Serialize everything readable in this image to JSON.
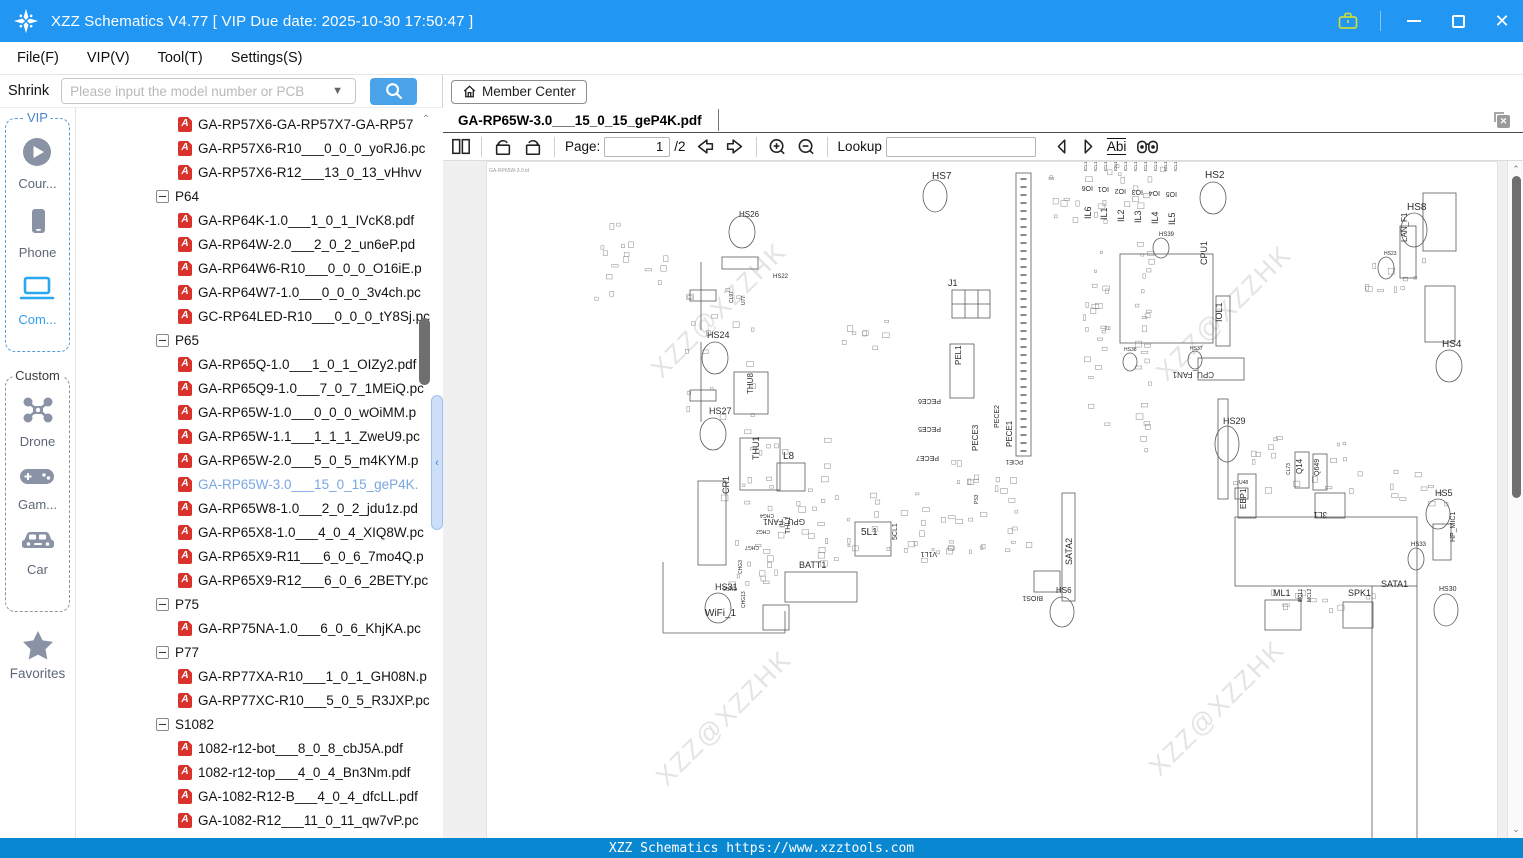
{
  "window": {
    "title": "XZZ Schematics V4.77 [ VIP Due date: 2025-10-30 17:50:47 ]"
  },
  "menu": {
    "items": [
      "File(F)",
      "VIP(V)",
      "Tool(T)",
      "Settings(S)"
    ]
  },
  "search": {
    "shrink_label": "Shrink",
    "placeholder": "Please input the model number or PCB"
  },
  "member_center": {
    "label": "Member Center"
  },
  "sidebar": {
    "groups": [
      {
        "label": "VIP",
        "style": "vip",
        "items": [
          {
            "label": "Cour...",
            "icon": "play-circle-icon",
            "active": false
          },
          {
            "label": "Phone",
            "icon": "phone-icon",
            "active": false
          },
          {
            "label": "Com...",
            "icon": "laptop-icon",
            "active": true
          }
        ]
      },
      {
        "label": "Custom",
        "style": "custom",
        "items": [
          {
            "label": "Drone",
            "icon": "drone-icon",
            "active": false
          },
          {
            "label": "Gam...",
            "icon": "gamepad-icon",
            "active": false
          },
          {
            "label": "Car",
            "icon": "car-icon",
            "active": false
          }
        ]
      }
    ],
    "favorites": {
      "label": "Favorites",
      "icon": "star-icon"
    }
  },
  "tree": {
    "items": [
      {
        "type": "file",
        "label": "GA-RP57X6-GA-RP57X7-GA-RP57"
      },
      {
        "type": "file",
        "label": "GA-RP57X6-R10___0_0_0_yoRJ6.pc"
      },
      {
        "type": "file",
        "label": "GA-RP57X6-R12___13_0_13_vHhvv"
      },
      {
        "type": "group",
        "label": "P64"
      },
      {
        "type": "file",
        "label": "GA-RP64K-1.0___1_0_1_IVcK8.pdf"
      },
      {
        "type": "file",
        "label": "GA-RP64W-2.0___2_0_2_un6eP.pd"
      },
      {
        "type": "file",
        "label": "GA-RP64W6-R10___0_0_0_O16iE.p"
      },
      {
        "type": "file",
        "label": "GA-RP64W7-1.0___0_0_0_3v4ch.pc"
      },
      {
        "type": "file",
        "label": "GC-RP64LED-R10___0_0_0_tY8Sj.pc"
      },
      {
        "type": "group",
        "label": "P65"
      },
      {
        "type": "file",
        "label": "GA-RP65Q-1.0___1_0_1_OIZy2.pdf"
      },
      {
        "type": "file",
        "label": "GA-RP65Q9-1.0___7_0_7_1MEiQ.pc"
      },
      {
        "type": "file",
        "label": "GA-RP65W-1.0___0_0_0_wOiMM.p"
      },
      {
        "type": "file",
        "label": "GA-RP65W-1.1___1_1_1_ZweU9.pc"
      },
      {
        "type": "file",
        "label": "GA-RP65W-2.0___5_0_5_m4KYM.p"
      },
      {
        "type": "file",
        "label": "GA-RP65W-3.0___15_0_15_geP4K.",
        "selected": true
      },
      {
        "type": "file",
        "label": "GA-RP65W8-1.0___2_0_2_jdu1z.pd"
      },
      {
        "type": "file",
        "label": "GA-RP65X8-1.0___4_0_4_XIQ8W.pc"
      },
      {
        "type": "file",
        "label": "GA-RP65X9-R11___6_0_6_7mo4Q.p"
      },
      {
        "type": "file",
        "label": "GA-RP65X9-R12___6_0_6_2BETY.pc"
      },
      {
        "type": "group",
        "label": "P75"
      },
      {
        "type": "file",
        "label": "GA-RP75NA-1.0___6_0_6_KhjKA.pc"
      },
      {
        "type": "group",
        "label": "P77"
      },
      {
        "type": "file",
        "label": "GA-RP77XA-R10___1_0_1_GH08N.p"
      },
      {
        "type": "file",
        "label": "GA-RP77XC-R10___5_0_5_R3JXP.pc"
      },
      {
        "type": "group",
        "label": "S1082"
      },
      {
        "type": "file",
        "label": "1082-r12-bot___8_0_8_cbJ5A.pdf"
      },
      {
        "type": "file",
        "label": "1082-r12-top___4_0_4_Bn3Nm.pdf"
      },
      {
        "type": "file",
        "label": "GA-1082-R12-B___4_0_4_dfcLL.pdf"
      },
      {
        "type": "file",
        "label": "GA-1082-R12___11_0_11_qw7vP.pc"
      }
    ]
  },
  "viewer": {
    "tab": {
      "title": "GA-RP65W-3.0___15_0_15_geP4K.pdf"
    },
    "toolbar": {
      "page_label": "Page:",
      "page_value": "1",
      "page_total": "/2",
      "lookup_label": "Lookup",
      "lookup_value": "",
      "abi_label": "Abi"
    }
  },
  "statusbar": {
    "text": "XZZ Schematics https://www.xzztools.com"
  },
  "schematic": {
    "page_label": "GA-RP65W-3.0.td",
    "stroke": "#5a5a5a",
    "label_color": "#2b2b2b",
    "watermark": {
      "text": "XZZ@XZZHK",
      "color": "#e4e4e4"
    },
    "watermark_positions": [
      [
        238,
        154
      ],
      [
        743,
        157
      ],
      [
        243,
        562
      ],
      [
        736,
        552
      ]
    ],
    "labels": [
      {
        "t": "HS7",
        "x": 445,
        "y": 17,
        "s": 10
      },
      {
        "t": "HS26",
        "x": 252,
        "y": 55,
        "s": 8
      },
      {
        "t": "HS22",
        "x": 286,
        "y": 116,
        "s": 6
      },
      {
        "t": "HS24",
        "x": 220,
        "y": 176,
        "s": 9
      },
      {
        "t": "HS27",
        "x": 222,
        "y": 252,
        "s": 9
      },
      {
        "t": "L8",
        "x": 296,
        "y": 297,
        "s": 10
      },
      {
        "t": "HS31",
        "x": 228,
        "y": 428,
        "s": 9
      },
      {
        "t": "WiFi_1",
        "x": 218,
        "y": 454,
        "s": 10
      },
      {
        "t": "BATT1",
        "x": 312,
        "y": 406,
        "s": 9
      },
      {
        "t": "5L1",
        "x": 374,
        "y": 373,
        "s": 10
      },
      {
        "t": "J1",
        "x": 461,
        "y": 124,
        "s": 9
      },
      {
        "t": "HS2",
        "x": 718,
        "y": 16,
        "s": 10
      },
      {
        "t": "HS39",
        "x": 672,
        "y": 74,
        "s": 6
      },
      {
        "t": "HS38",
        "x": 637,
        "y": 189,
        "s": 5
      },
      {
        "t": "HS37",
        "x": 703,
        "y": 188,
        "s": 5
      },
      {
        "t": "HS29",
        "x": 736,
        "y": 262,
        "s": 9
      },
      {
        "t": "HS8",
        "x": 920,
        "y": 48,
        "s": 10
      },
      {
        "t": "HS23",
        "x": 897,
        "y": 93,
        "s": 5
      },
      {
        "t": "HS4",
        "x": 955,
        "y": 185,
        "s": 10
      },
      {
        "t": "HS5",
        "x": 948,
        "y": 334,
        "s": 9
      },
      {
        "t": "HS6",
        "x": 569,
        "y": 431,
        "s": 8
      },
      {
        "t": "HS33",
        "x": 924,
        "y": 384,
        "s": 6
      },
      {
        "t": "HS30",
        "x": 952,
        "y": 429,
        "s": 7
      },
      {
        "t": "SATA1",
        "x": 894,
        "y": 425,
        "s": 9
      },
      {
        "t": "ML1",
        "x": 786,
        "y": 434,
        "s": 9
      },
      {
        "t": "SPK1",
        "x": 861,
        "y": 434,
        "s": 9
      },
      {
        "t": "U48",
        "x": 752,
        "y": 322,
        "s": 5
      },
      {
        "t": "THU8",
        "x": 266,
        "y": 232,
        "s": 8,
        "r": -90
      },
      {
        "t": "THU1",
        "x": 272,
        "y": 298,
        "s": 9,
        "r": -90
      },
      {
        "t": "CR1",
        "x": 242,
        "y": 332,
        "s": 9,
        "r": -90
      },
      {
        "t": "THL1",
        "x": 303,
        "y": 372,
        "s": 7,
        "r": -90
      },
      {
        "t": "5CL1",
        "x": 410,
        "y": 378,
        "s": 7,
        "r": -90
      },
      {
        "t": "PEL1",
        "x": 474,
        "y": 203,
        "s": 8,
        "r": -90
      },
      {
        "t": "PECE3",
        "x": 491,
        "y": 289,
        "s": 8,
        "r": -90
      },
      {
        "t": "PECE2",
        "x": 512,
        "y": 266,
        "s": 7,
        "r": -90
      },
      {
        "t": "PECE1",
        "x": 525,
        "y": 285,
        "s": 8,
        "r": -90
      },
      {
        "t": "SATA2",
        "x": 585,
        "y": 403,
        "s": 9,
        "r": -90
      },
      {
        "t": "IL6",
        "x": 604,
        "y": 57,
        "s": 9,
        "r": -90
      },
      {
        "t": "IL1",
        "x": 620,
        "y": 58,
        "s": 9,
        "r": -90
      },
      {
        "t": "IL2",
        "x": 637,
        "y": 60,
        "s": 9,
        "r": -90
      },
      {
        "t": "IL3",
        "x": 654,
        "y": 61,
        "s": 9,
        "r": -90
      },
      {
        "t": "IL4",
        "x": 671,
        "y": 62,
        "s": 9,
        "r": -90
      },
      {
        "t": "IL5",
        "x": 688,
        "y": 63,
        "s": 9,
        "r": -90
      },
      {
        "t": "CPU1",
        "x": 720,
        "y": 103,
        "s": 9,
        "r": -90
      },
      {
        "t": "IOL1",
        "x": 735,
        "y": 160,
        "s": 9,
        "r": -90
      },
      {
        "t": "LAN_F1",
        "x": 920,
        "y": 80,
        "s": 8,
        "r": -90
      },
      {
        "t": "HP_MIC1",
        "x": 968,
        "y": 380,
        "s": 7,
        "r": -90
      },
      {
        "t": "Q14",
        "x": 815,
        "y": 312,
        "s": 8,
        "r": -90
      },
      {
        "t": "Q649",
        "x": 832,
        "y": 314,
        "s": 7,
        "r": -90
      },
      {
        "t": "CL73",
        "x": 803,
        "y": 313,
        "s": 5,
        "r": -90
      },
      {
        "t": "EBP1",
        "x": 759,
        "y": 347,
        "s": 8,
        "r": -90
      },
      {
        "t": "MCL1",
        "x": 815,
        "y": 440,
        "s": 5,
        "r": -90
      },
      {
        "t": "MCL2",
        "x": 824,
        "y": 440,
        "s": 5,
        "r": -90
      },
      {
        "t": "CL97",
        "x": 246,
        "y": 141,
        "s": 5,
        "r": -90
      },
      {
        "t": "U77",
        "x": 258,
        "y": 143,
        "s": 5,
        "r": -90
      },
      {
        "t": "CHG3",
        "x": 255,
        "y": 412,
        "s": 5,
        "r": -90
      },
      {
        "t": "CHG13",
        "x": 258,
        "y": 446,
        "s": 5,
        "r": -90
      },
      {
        "t": "PS3",
        "x": 491,
        "y": 342,
        "s": 5,
        "r": -90
      },
      {
        "t": "IO6",
        "x": 606,
        "y": 24,
        "s": 7,
        "r": 180
      },
      {
        "t": "IO1",
        "x": 622,
        "y": 25,
        "s": 7,
        "r": 180
      },
      {
        "t": "IO2",
        "x": 639,
        "y": 27,
        "s": 7,
        "r": 180
      },
      {
        "t": "IO3",
        "x": 656,
        "y": 28,
        "s": 7,
        "r": 180
      },
      {
        "t": "IO4",
        "x": 673,
        "y": 29,
        "s": 7,
        "r": 180
      },
      {
        "t": "IO5",
        "x": 690,
        "y": 30,
        "s": 7,
        "r": 180
      },
      {
        "t": "PECE6",
        "x": 454,
        "y": 237,
        "s": 7,
        "r": 180
      },
      {
        "t": "PECE5",
        "x": 454,
        "y": 265,
        "s": 7,
        "r": 180
      },
      {
        "t": "PECE7",
        "x": 452,
        "y": 294,
        "s": 7,
        "r": 180
      },
      {
        "t": "PCIE1",
        "x": 536,
        "y": 298,
        "s": 6,
        "r": 180
      },
      {
        "t": "CPU_FAN1",
        "x": 727,
        "y": 210,
        "s": 8,
        "r": 180
      },
      {
        "t": "GPU_FAN1",
        "x": 318,
        "y": 357,
        "s": 8,
        "r": 180
      },
      {
        "t": "V1L1",
        "x": 450,
        "y": 390,
        "s": 7,
        "r": 180
      },
      {
        "t": "BIOS1",
        "x": 556,
        "y": 434,
        "s": 7,
        "r": 180
      },
      {
        "t": "3L1",
        "x": 840,
        "y": 350,
        "s": 8,
        "r": 180
      },
      {
        "t": "CHG4",
        "x": 287,
        "y": 352,
        "s": 5,
        "r": 180
      },
      {
        "t": "CHG2",
        "x": 283,
        "y": 368,
        "s": 5,
        "r": 180
      },
      {
        "t": "CHG7",
        "x": 272,
        "y": 384,
        "s": 5,
        "r": 180
      },
      {
        "t": "CHG6",
        "x": 250,
        "y": 425,
        "s": 5,
        "r": 180
      },
      {
        "t": "ICL11",
        "x": 600,
        "y": 9,
        "s": 4.5,
        "r": -90
      },
      {
        "t": "ICL12",
        "x": 610,
        "y": 9,
        "s": 4.5,
        "r": -90
      },
      {
        "t": "ICL13",
        "x": 620,
        "y": 9,
        "s": 4.5,
        "r": -90
      },
      {
        "t": "ICL14",
        "x": 630,
        "y": 9,
        "s": 4.5,
        "r": -90
      },
      {
        "t": "ICL15",
        "x": 640,
        "y": 9,
        "s": 4.5,
        "r": -90
      },
      {
        "t": "ICL16",
        "x": 650,
        "y": 9,
        "s": 4.5,
        "r": -90
      },
      {
        "t": "ICL17",
        "x": 660,
        "y": 9,
        "s": 4.5,
        "r": -90
      },
      {
        "t": "ICL18",
        "x": 670,
        "y": 9,
        "s": 4.5,
        "r": -90
      },
      {
        "t": "ICL19",
        "x": 680,
        "y": 9,
        "s": 4.5,
        "r": -90
      },
      {
        "t": "ICL10",
        "x": 690,
        "y": 9,
        "s": 4.5,
        "r": -90
      }
    ],
    "ellipses": [
      [
        448,
        34,
        12,
        16
      ],
      [
        255,
        70,
        13,
        16
      ],
      [
        228,
        196,
        13,
        16
      ],
      [
        226,
        272,
        13,
        16
      ],
      [
        231,
        446,
        13,
        15
      ],
      [
        726,
        36,
        13,
        16
      ],
      [
        674,
        86,
        8,
        10
      ],
      [
        643,
        200,
        7,
        9
      ],
      [
        708,
        198,
        7,
        9
      ],
      [
        740,
        282,
        12,
        18
      ],
      [
        927,
        68,
        13,
        17
      ],
      [
        899,
        106,
        8,
        11
      ],
      [
        962,
        204,
        13,
        16
      ],
      [
        951,
        352,
        12,
        15
      ],
      [
        575,
        450,
        12,
        15
      ],
      [
        929,
        397,
        8,
        11
      ],
      [
        959,
        448,
        12,
        16
      ]
    ],
    "rects": [
      [
        633,
        92,
        93,
        89
      ],
      [
        729,
        134,
        14,
        50
      ],
      [
        711,
        196,
        46,
        22
      ],
      [
        529,
        11,
        15,
        283
      ],
      [
        465,
        128,
        38,
        28
      ],
      [
        463,
        182,
        24,
        54
      ],
      [
        298,
        410,
        72,
        30
      ],
      [
        368,
        360,
        36,
        34
      ],
      [
        211,
        319,
        28,
        84
      ],
      [
        253,
        276,
        40,
        52
      ],
      [
        247,
        210,
        34,
        42
      ],
      [
        290,
        301,
        28,
        28
      ],
      [
        913,
        64,
        16,
        52
      ],
      [
        936,
        31,
        33,
        58
      ],
      [
        938,
        124,
        30,
        56
      ],
      [
        778,
        438,
        36,
        30
      ],
      [
        856,
        440,
        30,
        26
      ],
      [
        946,
        362,
        18,
        36
      ],
      [
        751,
        312,
        18,
        44
      ],
      [
        828,
        331,
        30,
        25
      ],
      [
        808,
        290,
        14,
        36
      ],
      [
        826,
        292,
        14,
        36
      ],
      [
        748,
        326,
        13,
        11
      ],
      [
        748,
        355,
        182,
        69
      ],
      [
        547,
        409,
        26,
        21
      ],
      [
        575,
        331,
        13,
        108
      ],
      [
        731,
        237,
        10,
        100
      ],
      [
        276,
        443,
        26,
        25
      ],
      [
        203,
        128,
        26,
        11
      ],
      [
        203,
        228,
        26,
        11
      ],
      [
        235,
        95,
        36,
        12
      ]
    ],
    "lines": [
      [
        885,
        424,
        885,
        677
      ],
      [
        930,
        424,
        930,
        677
      ],
      [
        176,
        400,
        176,
        471
      ],
      [
        176,
        471,
        298,
        471
      ],
      [
        298,
        471,
        298,
        449
      ],
      [
        214,
        100,
        214,
        168
      ],
      [
        214,
        180,
        214,
        260
      ],
      [
        478,
        128,
        478,
        156
      ],
      [
        491,
        128,
        491,
        156
      ],
      [
        465,
        142,
        503,
        142
      ]
    ],
    "pcie_pins": {
      "x": 536.5,
      "y1": 16,
      "y2": 290
    },
    "noise_clusters": [
      [
        95,
        60,
        120,
        80,
        16
      ],
      [
        196,
        118,
        70,
        140,
        18
      ],
      [
        232,
        262,
        110,
        110,
        22
      ],
      [
        300,
        330,
        150,
        75,
        28
      ],
      [
        432,
        335,
        110,
        55,
        20
      ],
      [
        455,
        295,
        70,
        45,
        12
      ],
      [
        560,
        2,
        130,
        60,
        22
      ],
      [
        596,
        62,
        24,
        200,
        22
      ],
      [
        648,
        24,
        14,
        270,
        26
      ],
      [
        742,
        272,
        130,
        55,
        18
      ],
      [
        878,
        92,
        60,
        45,
        10
      ],
      [
        782,
        426,
        110,
        28,
        12
      ],
      [
        902,
        300,
        60,
        45,
        10
      ],
      [
        240,
        360,
        60,
        70,
        14
      ],
      [
        340,
        150,
        60,
        40,
        8
      ]
    ]
  }
}
